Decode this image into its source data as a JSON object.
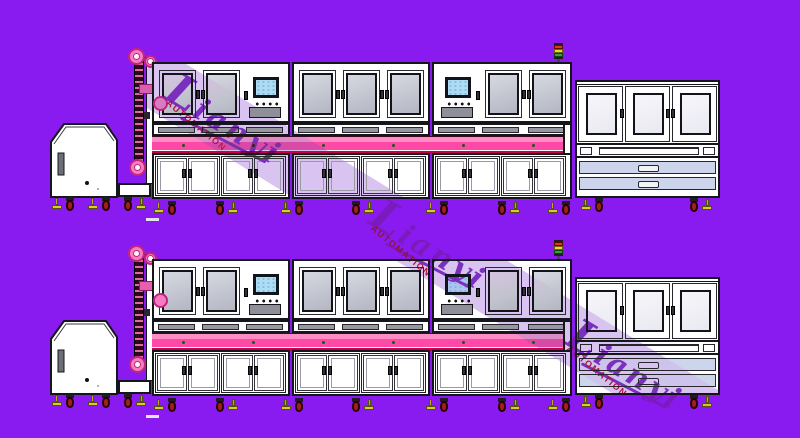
{
  "scene": {
    "type": "cad-production-line-drawing",
    "lines": [
      {
        "name": "production-line-1"
      },
      {
        "name": "production-line-2"
      }
    ],
    "units": [
      "feeder-hopper",
      "chain-elevator",
      "assembly-line-3-bays",
      "offline-drawer-station"
    ],
    "indicators": {
      "tower_light_colors": [
        "red",
        "yellow",
        "green"
      ]
    }
  },
  "watermark": {
    "brand": "Lianyi",
    "subtitle": "AUTOMATION",
    "instances": 3
  },
  "colors": {
    "background": "#8A1BF0",
    "machine_body": "#FFFFFF",
    "outline": "#15161B",
    "window_glass": "#C7C9D4",
    "window_glass_light": "#F2F2F7",
    "sill_gray": "#97979F",
    "conveyor_pink": "#FF49A6",
    "conveyor_pink_light": "#FF8CC5",
    "conveyor_crimson": "#C7004C",
    "sprocket_pink": "#F77BC2",
    "sprocket_rim": "#C2257E",
    "drawer_lavender": "#CDD5ED",
    "monitor_screen": "#ADDCF5",
    "tower_red": "#E63322",
    "tower_yellow": "#E8D82A",
    "tower_green": "#37A03C",
    "caster_wheel": "#A02020",
    "caster_foot": "#D8CC2A",
    "watermark_stripe": "#D9C3F0",
    "watermark_text": "#7B2FBF",
    "watermark_sub": "#B01040"
  }
}
